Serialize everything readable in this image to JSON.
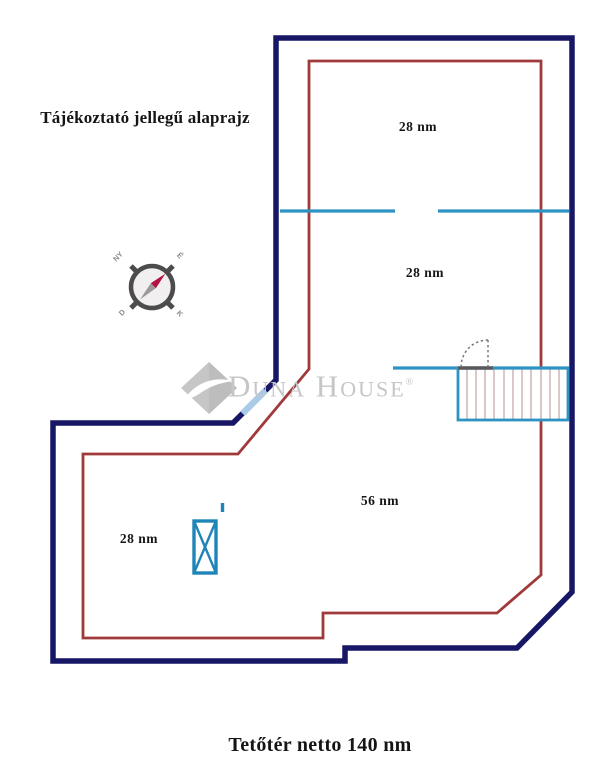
{
  "title": "Tájékoztató jellegű alaprajz",
  "footer": "Tetőtér netto 140 nm",
  "watermark": {
    "brand": "Duna House",
    "registered": "®"
  },
  "compass": {
    "nw": "NY",
    "ne": "É",
    "sw": "D",
    "se": "K"
  },
  "rooms": [
    {
      "label": "28 nm"
    },
    {
      "label": "28 nm"
    },
    {
      "label": "56 nm"
    },
    {
      "label": "28 nm"
    }
  ],
  "colors": {
    "outer_wall_navy": "#171766",
    "inner_line_red": "#a03a3a",
    "wall_blue": "#2d93c2",
    "window_pale_blue": "#aacbe7",
    "needle_red": "#b4123f",
    "logo_gray": "#c6c6c6"
  }
}
